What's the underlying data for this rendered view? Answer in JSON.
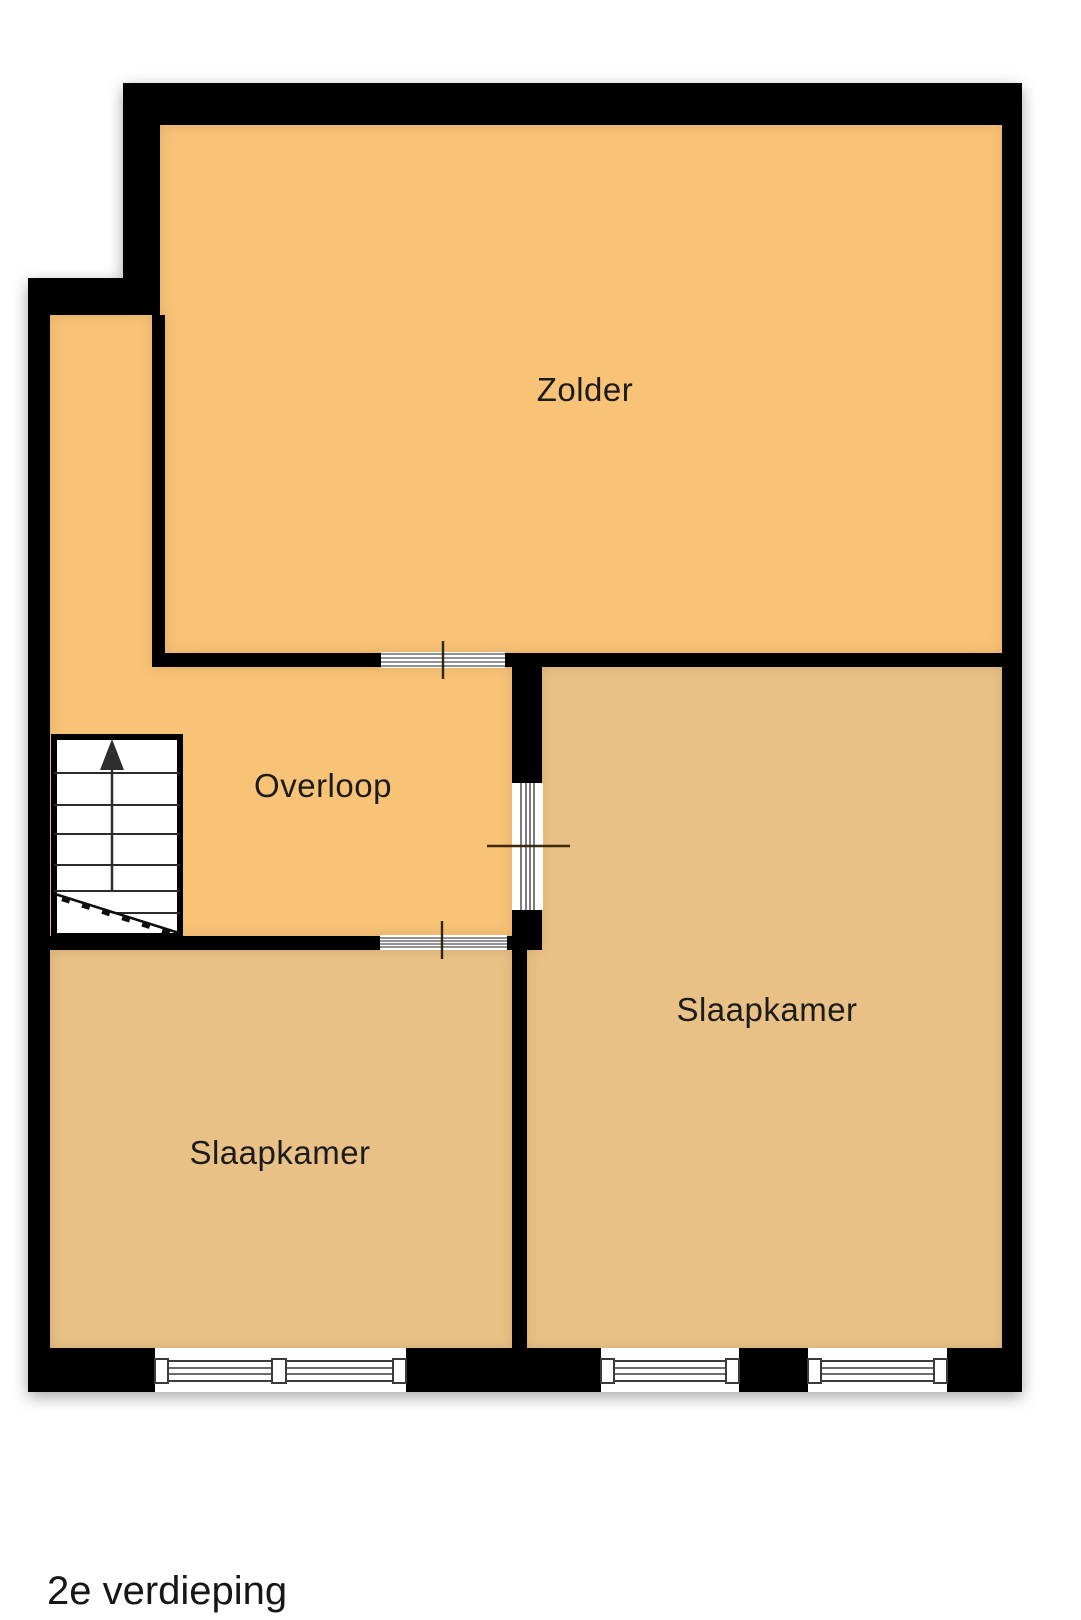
{
  "floor_label": "2e verdieping",
  "rooms": [
    {
      "name": "Zolder"
    },
    {
      "name": "Overloop"
    },
    {
      "name": "Slaapkamer"
    },
    {
      "name": "Slaapkamer"
    }
  ],
  "colors": {
    "room_light": "#F8C277",
    "room_dark": "#E9C186",
    "wall": "#000000",
    "stairs_fill": "#FFFFFF",
    "background": "#FFFFFF"
  },
  "icons": {
    "stairs_arrow": "up-arrow"
  }
}
